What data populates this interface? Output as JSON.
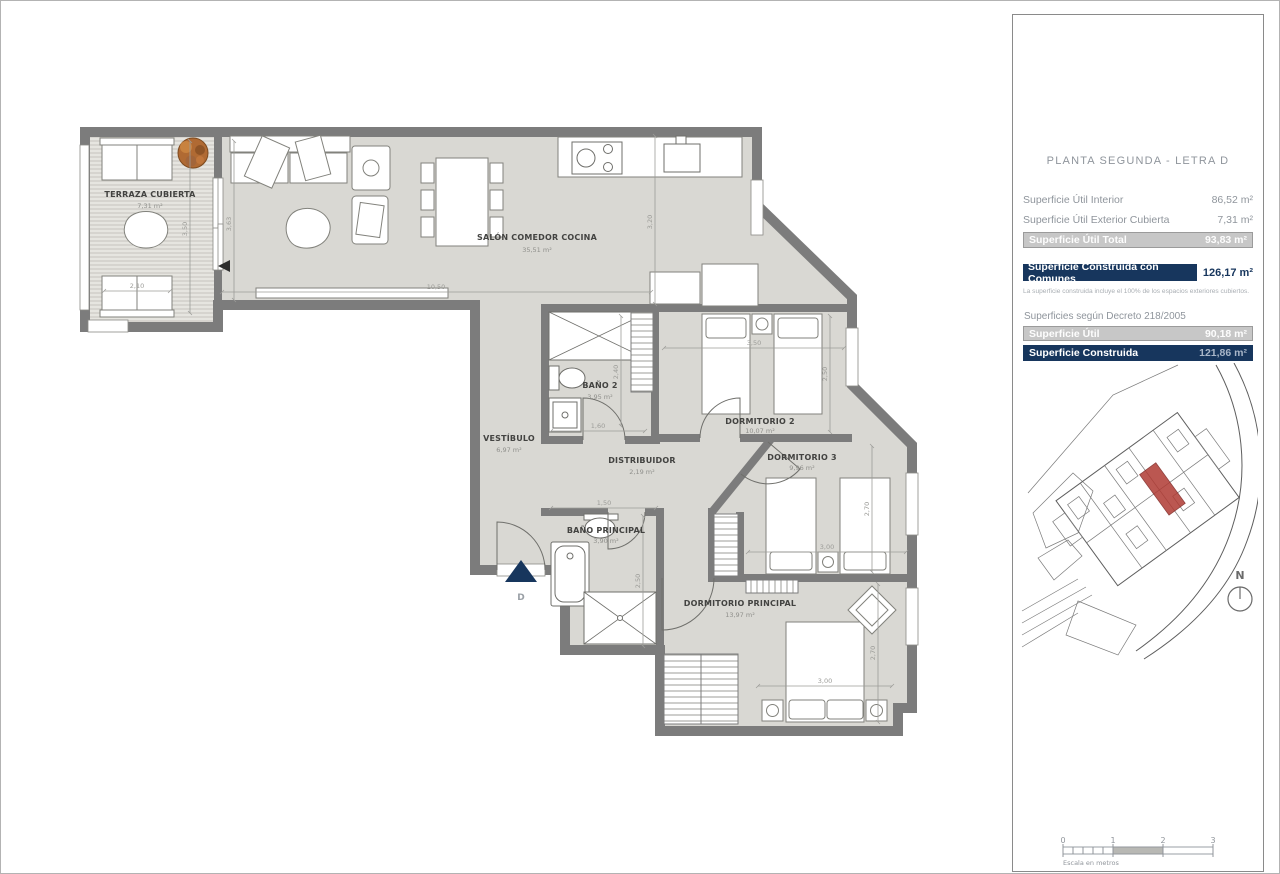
{
  "plan": {
    "entry_label": "D",
    "rooms": {
      "terraza": {
        "name": "TERRAZA CUBIERTA",
        "area": "7,31 m²"
      },
      "salon": {
        "name": "SALÓN COMEDOR COCINA",
        "area": "35,51 m²"
      },
      "bano2": {
        "name": "BAÑO 2",
        "area": "3,95 m²"
      },
      "vestibulo": {
        "name": "VESTÍBULO",
        "area": "6,97 m²"
      },
      "distribuidor": {
        "name": "DISTRIBUIDOR",
        "area": "2,19 m²"
      },
      "dorm2": {
        "name": "DORMITORIO 2",
        "area": "10,07 m²"
      },
      "dorm3": {
        "name": "DORMITORIO 3",
        "area": "9,96 m²"
      },
      "banop": {
        "name": "BAÑO PRINCIPAL",
        "area": "3,90 m²"
      },
      "dormp": {
        "name": "DORMITORIO PRINCIPAL",
        "area": "13,97 m²"
      }
    },
    "dims": {
      "salon_w": "10,50",
      "salon_h": "3,20",
      "terraza_h": "3,50",
      "salon_left_h": "3,63",
      "terraza_w": "2,10",
      "dorm2_w": "3,50",
      "dorm2_h": "2,50",
      "bano2_w": "1,60",
      "bano2_h": "2,40",
      "banop_w": "1,50",
      "banop_h": "2,50",
      "dorm3_w": "3,00",
      "dorm3_h": "2,70",
      "dormp_w": "3,00",
      "dormp_h": "2,70"
    }
  },
  "panel": {
    "title": "PLANTA SEGUNDA - LETRA D",
    "util_interior": {
      "label": "Superficie Útil Interior",
      "value": "86,52 m²"
    },
    "util_exterior": {
      "label": "Superficie Útil Exterior Cubierta",
      "value": "7,31 m²"
    },
    "util_total": {
      "label": "Superficie Útil Total",
      "value": "93,83 m²"
    },
    "construida_comunes": {
      "label": "Superficie Construida con Comunes",
      "value": "126,17 m²"
    },
    "construida_note": "La superficie construida incluye el 100% de los espacios exteriores cubiertos.",
    "decreto_heading": "Superficies según Decreto 218/2005",
    "decreto_util": {
      "label": "Superficie Útil",
      "value": "90,18 m²"
    },
    "decreto_construida": {
      "label": "Superficie Construida",
      "value": "121,86 m²"
    }
  },
  "compass": {
    "north_label": "N"
  },
  "scalebar": {
    "ticks": [
      "0",
      "1",
      "2",
      "3"
    ],
    "caption": "Escala en metros"
  },
  "colors": {
    "accent_navy": "#17365d",
    "highlight_red": "#b03a33",
    "wall_gray": "#7c7c7c",
    "floor_gray": "#d9d8d3"
  }
}
